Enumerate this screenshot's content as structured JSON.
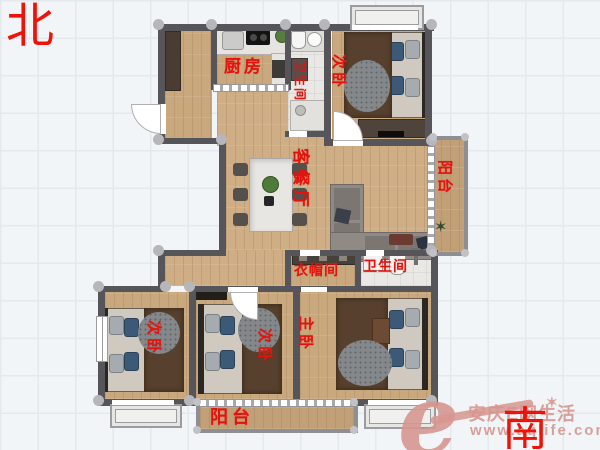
{
  "compass": {
    "north": "北",
    "south": "南"
  },
  "rooms": {
    "kitchen": {
      "label": "厨房"
    },
    "bath_top": {
      "label": "卫生间"
    },
    "bedroom_ne": {
      "label": "次卧"
    },
    "living_dining": {
      "label": "客餐厅"
    },
    "balcony_east": {
      "label": "阳台"
    },
    "cloakroom": {
      "label": "衣帽间"
    },
    "bathroom_main": {
      "label": "卫生间"
    },
    "bedroom_sw": {
      "label": "次卧"
    },
    "bedroom_s": {
      "label": "次卧"
    },
    "master_bedroom": {
      "label": "主卧"
    },
    "balcony_south": {
      "label": "阳台"
    }
  },
  "watermark": {
    "logo_letter": "e",
    "site_name": "安庆E网生活",
    "site_url": "www.aqlife.com",
    "star_icon": "✶"
  },
  "colors": {
    "label_red": "#e4130d",
    "compass_red": "#ee1208",
    "wall_gray": "#55555a",
    "wood_floor": "#c9a87e",
    "tile_floor": "#e9e8e4",
    "watermark_pink": "#d6968f"
  }
}
